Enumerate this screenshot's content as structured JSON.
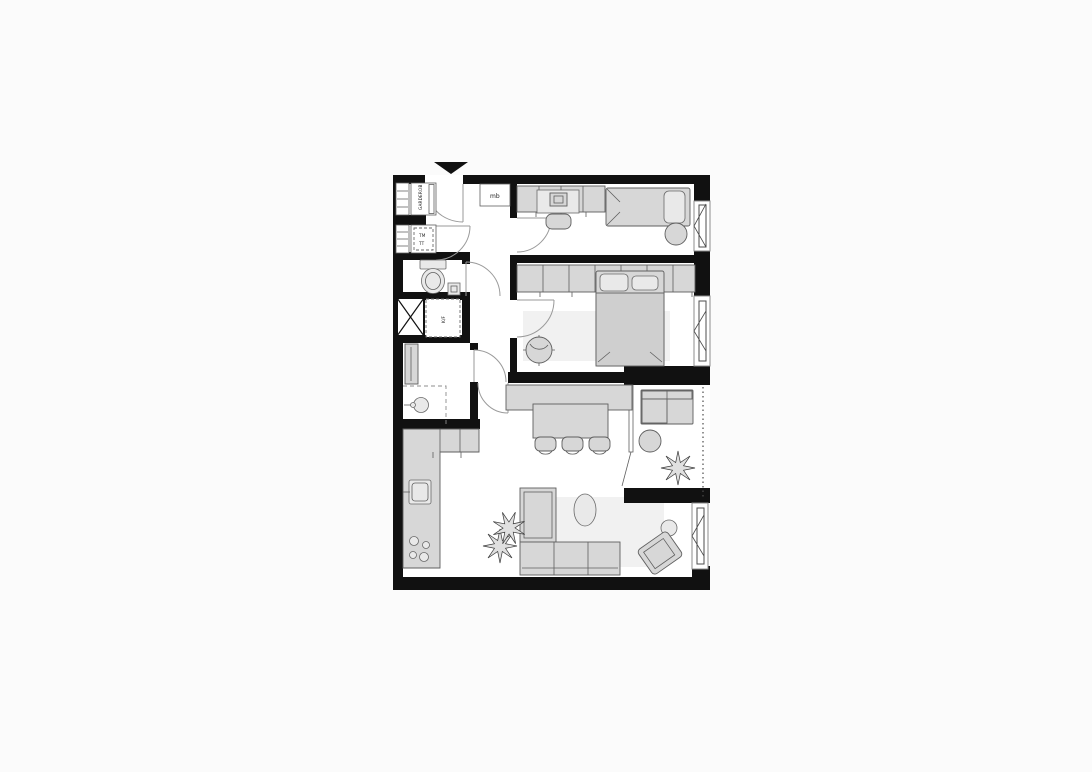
{
  "plan": {
    "labels": {
      "closet_top": "GARDEROB",
      "closet_mid_line1": "TM",
      "closet_mid_line2": "TT",
      "appliance": "K/F",
      "meter_box": "mb"
    },
    "icons": {
      "entrance_marker": "filled-triangle-down-icon"
    },
    "colors": {
      "wall": "#111111",
      "floor": "#ffffff",
      "furniture_fill": "#d7d7d7",
      "furniture_stroke": "#5f5f5f",
      "rug": "#f1f1f1",
      "door_arc": "#9a9a9a",
      "page_background": "#fbfbfb"
    }
  }
}
